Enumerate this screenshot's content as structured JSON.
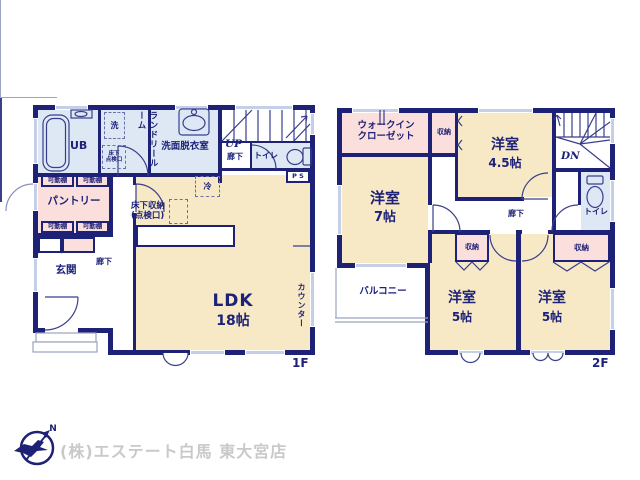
{
  "floor1": {
    "floor_label": "1F",
    "ub": "UB",
    "laundry_room": "ランドリールーム",
    "washer": "洗",
    "underfloor_hatch": "床下\n点検口",
    "washroom": "洗面脱衣室",
    "stairs_up": "UP",
    "upper_hall": "廊下",
    "toilet": "トイレ",
    "pipe_space": "P S",
    "movable_shelf": "可動棚",
    "pantry": "パントリー",
    "entrance": "玄関",
    "hall": "廊下",
    "fridge": "冷",
    "underfloor_storage": "床下収納\n(点検口)",
    "ldk": "LDK",
    "ldk_size": "18帖",
    "counter": "カウンター"
  },
  "floor2": {
    "floor_label": "2F",
    "wic": "ウォークイン\nクローゼット",
    "closet": "収納",
    "room45": "洋室",
    "room45_size": "4.5帖",
    "stairs_dn": "DN",
    "toilet": "トイレ",
    "room7": "洋室",
    "room7_size": "7帖",
    "hall": "廊下",
    "balcony": "バルコニー",
    "room5_left": "洋室",
    "room5_left_size": "5帖",
    "room5_right": "洋室",
    "room5_right_size": "5帖"
  },
  "footer": {
    "company": "(株)エステート白馬 東大宮店",
    "compass_north": "N"
  },
  "colors": {
    "wall": "#1e2277",
    "line": "#3a3f8c",
    "tatami": "#f7e9c6",
    "closet": "#fadfdd",
    "wet": "#dde8f4",
    "window": "#c6cfe8",
    "text": "#1d2178",
    "footer-text": "#c9c9c9"
  }
}
